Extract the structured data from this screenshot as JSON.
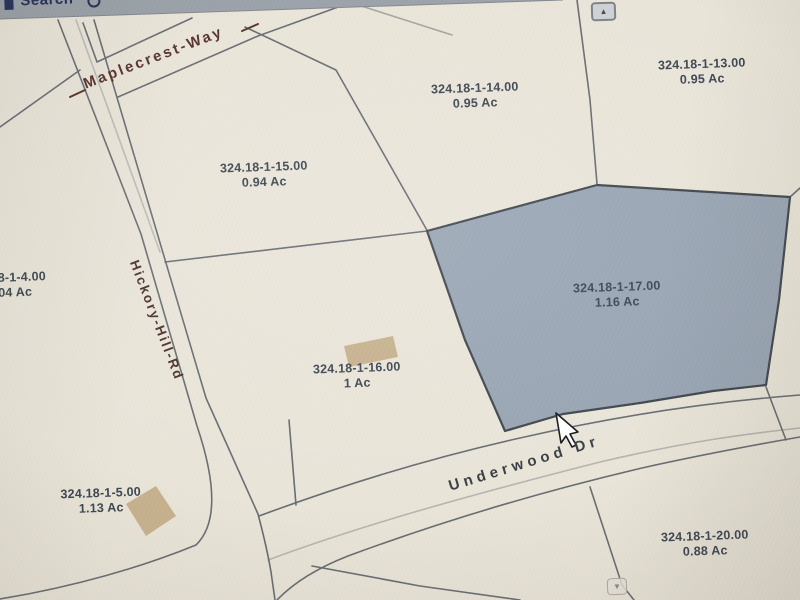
{
  "toolbar": {
    "search_label": "Search"
  },
  "scrollbar": {
    "up_icon": "▲",
    "down_icon": "▼"
  },
  "streets": {
    "maplecrest": "Maplecrest-Way",
    "hickory": "Hickory-Hill-Rd",
    "underwood": "Underwood Dr"
  },
  "parcels": [
    {
      "id": "8-1-4.00",
      "acreage": "04 Ac",
      "note": "clipped at left edge"
    },
    {
      "id": "324.18-1-13.00",
      "acreage": "0.95 Ac"
    },
    {
      "id": "324.18-1-14.00",
      "acreage": "0.95 Ac"
    },
    {
      "id": "324.18-1-15.00",
      "acreage": "0.94 Ac"
    },
    {
      "id": "324.18-1-16.00",
      "acreage": "1 Ac"
    },
    {
      "id": "324.18-1-17.00",
      "acreage": "1.16 Ac",
      "selected": true
    },
    {
      "id": "324.18-1-5.00",
      "acreage": "1.13 Ac"
    },
    {
      "id": "324.18-1-20.00",
      "acreage": "0.88 Ac"
    }
  ],
  "colors": {
    "background": "#eae5d8",
    "selected_parcel": "#93a1b3",
    "selected_parcel_outline": "#3f474f",
    "parcel_line": "#686d74",
    "building": "#c9b28c",
    "toolbar": "#9aa1a9",
    "street_label_brown": "#59312a",
    "parcel_label": "#3b4652"
  }
}
